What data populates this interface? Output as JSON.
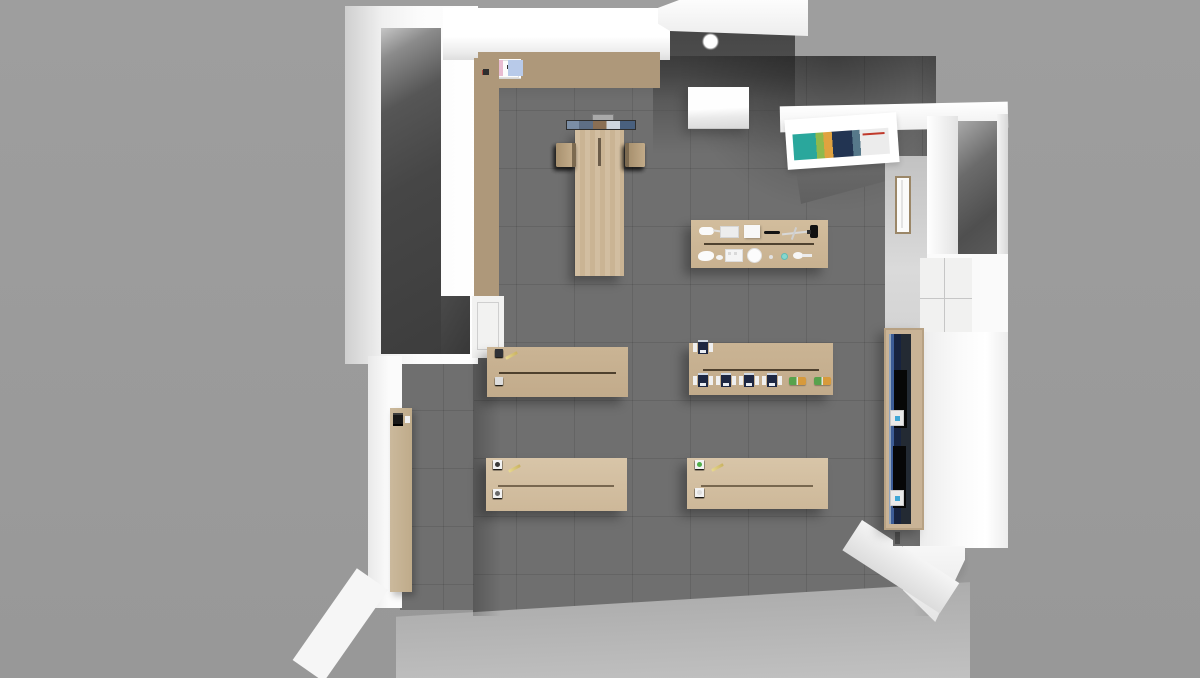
{
  "scene": {
    "type": "3d-room-render",
    "subject": "Top-down 3D rendering of a science classroom / laboratory floor plan",
    "view": "overhead"
  },
  "palette": {
    "background": "#9b9b9b",
    "wall": "#f8f8f7",
    "floor": "#6f6f6f",
    "floor_lit": "#bcbcbc",
    "storage_floor": "#454545",
    "table_wood": "#ccb697",
    "frame_wood": "#ae987a",
    "device_navy": "#1d2742",
    "accent_teal": "#49b8b2",
    "accent_blue": "#5b86c2",
    "accent_green": "#4fae49",
    "accent_orange": "#d79a3c"
  },
  "counts": {
    "conference_chairs_left": 4,
    "conference_chairs_right": 4,
    "table_slots": 3,
    "top_shelf_units": 3,
    "left_shelf_cells": 6,
    "wall_counter_stations": 7,
    "microscopes_top_row": 6,
    "microscopes_bottom_row": 4,
    "test_kits": 2,
    "kit_row1": 6,
    "kit_row2": 6,
    "burner_left_row1": 6,
    "burner_left_row2": 6,
    "burner_right_row1": 6,
    "burner_right_row2": 6
  },
  "colors": {
    "kit_row1": [
      "#5b86c2",
      "#49b8b2",
      "#49b8b2",
      "#5b86c2",
      "#2f3136",
      "#2f3136"
    ],
    "kit_row2": [
      "#d98d7f",
      "#e9e9e9",
      "#7a93c4",
      "#9fd6d0",
      "#e9e9e9",
      "#dddddd"
    ],
    "burner_left_row1_dots": [
      "#3a3a3a",
      "#57b44e",
      "#57b44e",
      "#57b44e",
      "#3a3a3a",
      "#3a3a3a"
    ],
    "burner_left_row2_dots": [
      "#8a8a8a",
      "#cfcfcf",
      "#cfcfcf",
      "#cfcfcf",
      "#6a6a6a",
      "#6a6a6a"
    ],
    "burner_right_row1_dots": [
      "#4fae49",
      "#4fae49",
      "#4fae49",
      "#4fae49",
      "#4fae49",
      "#4fae49"
    ],
    "burner_right_row2_dots": [
      "#dddddd",
      "#dddddd",
      "#dddddd",
      "#dddddd",
      "#dddddd",
      "#dddddd"
    ]
  },
  "objects": {
    "storage_room": "dark storage room (top left)",
    "top_shelves": "wall shelving with paper and pink/blue supplies",
    "left_shelf": "tall wall shelf unit",
    "ceiling_light": "white ceiling lamp cluster",
    "wall_cabinet_box": "white wall-mounted cabinet",
    "smartboard": "interactive whiteboard at head of table",
    "conference_table": "conference table with 8 wooden chairs",
    "demo_bench": "teacher demo bench with lab tools (wash bottle, trays, pipette, boom stand, faucet, dishes)",
    "microscope_bench": "bench with 10 microscopes and 2 green/orange kits",
    "kit_bench": "bench with colored experiment kits",
    "burner_bench_left": "student bench with burners/lamps",
    "burner_bench_right": "student bench with burners/lamps",
    "wall_counter": "side counter with 7 dark instruments",
    "blue_cabinet": "tall cabinet with blue equipment",
    "poster": "colorful wall poster",
    "door": "door with narrow vision panel",
    "alcove": "recessed wall niche (top right)"
  }
}
